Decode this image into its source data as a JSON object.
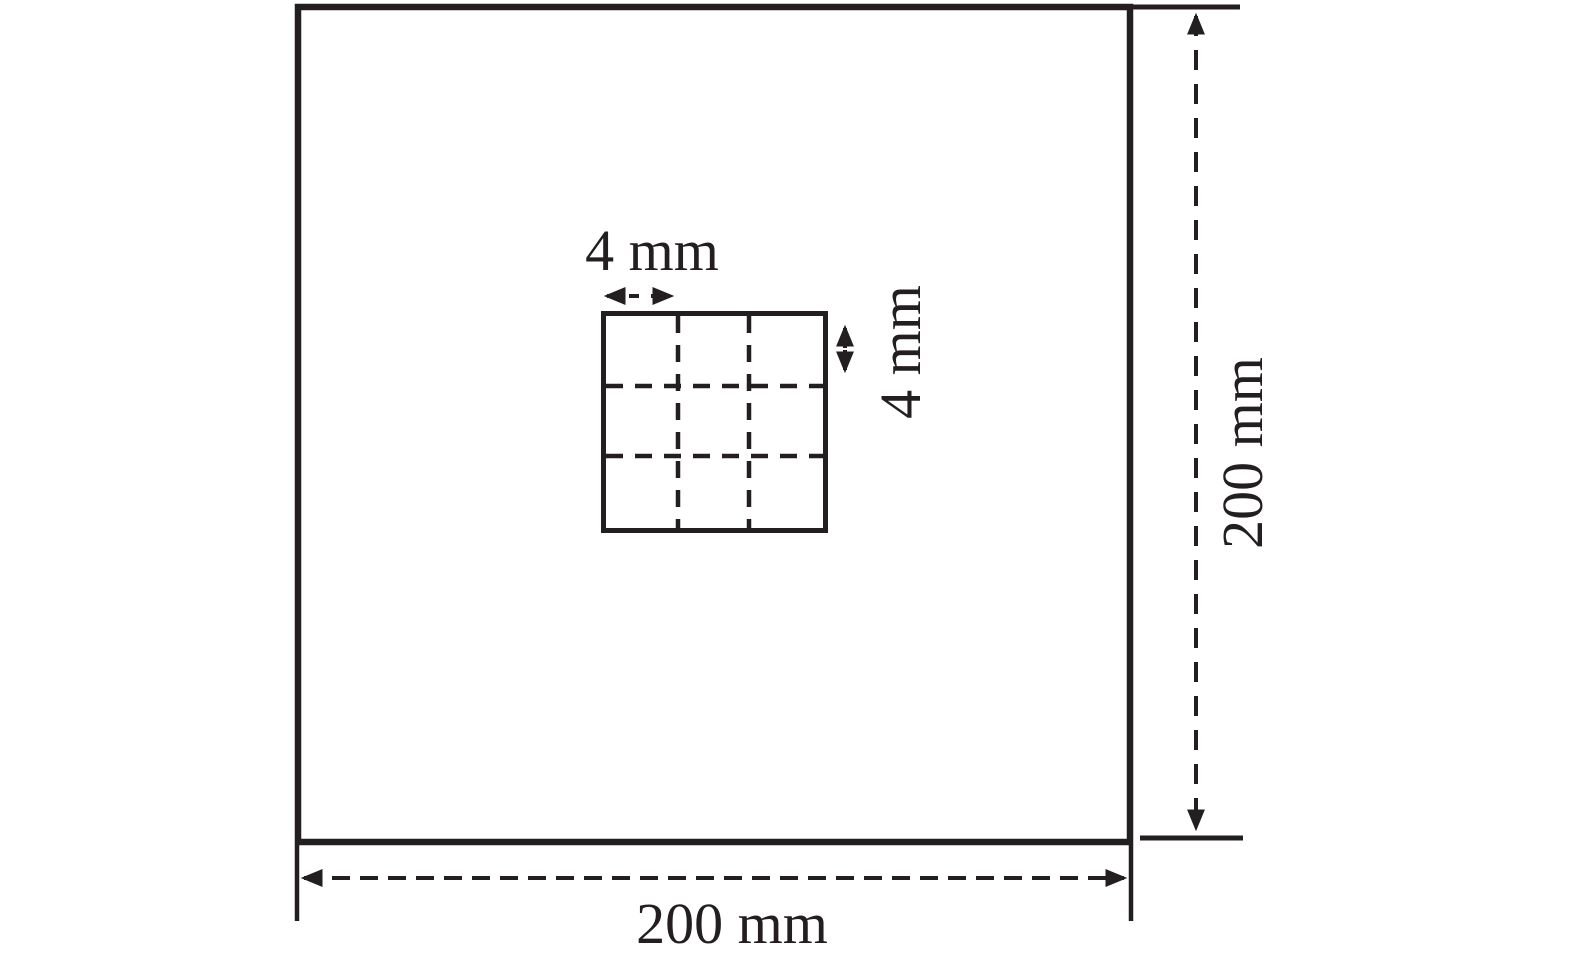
{
  "colors": {
    "ink": "#231f20",
    "bg": "#ffffff"
  },
  "figure": {
    "outer_square": {
      "width_label": "200 mm",
      "height_label": "200 mm"
    },
    "inner_grid": {
      "rows": 3,
      "cols": 3,
      "cell_width_label": "4 mm",
      "cell_height_label": "4 mm"
    }
  }
}
